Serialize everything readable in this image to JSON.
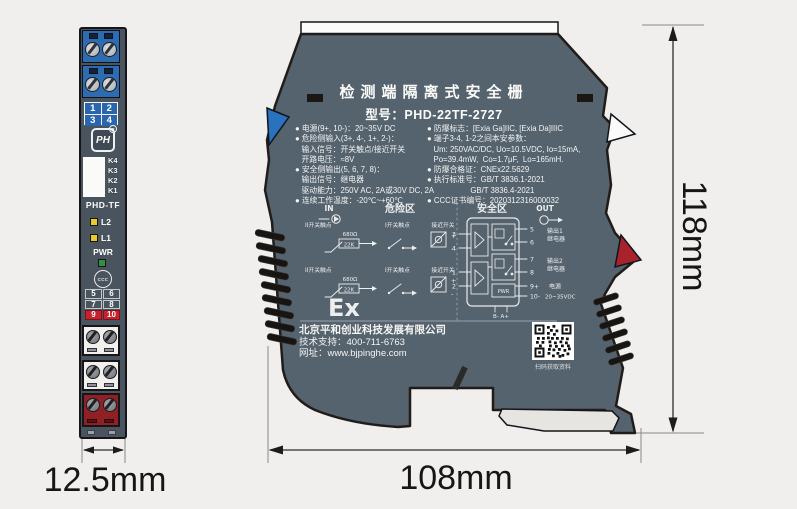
{
  "colors": {
    "background": "#f0efed",
    "body_gray": "#55636f",
    "front_gray": "#4a545e",
    "terminal_blue": "#2e6cb2",
    "terminal_red": "#8e2026",
    "tag_red": "#c4222c",
    "led_yellow": "#e8c92a",
    "led_green": "#2f9240"
  },
  "front": {
    "t_top": [
      "1",
      "2",
      "3",
      "4"
    ],
    "k": [
      "K4",
      "K3",
      "K2",
      "K1"
    ],
    "model": "PHD-TF",
    "l2": "L2",
    "l1": "L1",
    "pwr": "PWR",
    "ccc": "CCC",
    "logo": "PH",
    "reg": "R",
    "t_mid": [
      "5",
      "6",
      "7",
      "8"
    ],
    "t_pwr": [
      "9",
      "10"
    ]
  },
  "side": {
    "title": "检测端隔离式安全栅",
    "model": "型号：PHD-22TF-2727",
    "specs_left": [
      "● 电源(9+, 10-)：20~35V DC",
      "● 危险侧输入(3+, 4-, 1+, 2-)：",
      "   输入信号：开关触点/接近开关",
      "   开路电压：≈8V",
      "● 安全侧输出(5, 6, 7, 8)：",
      "   输出信号：继电器",
      "   驱动能力：250V AC, 2A或30V DC, 2A",
      "● 连续工作温度：-20℃~+60℃"
    ],
    "specs_right": [
      "● 防爆标志：[Exia Ga]IIC, [Exia Da]IIIC",
      "● 端子3-4, 1-2之间本安参数：",
      "   Um: 250VAC/DC, Uo=10.5VDC, Io=15mA,",
      "   Po=39.4mW,  Co=1.7μF,  Lo=165mH.",
      "● 防爆合格证：CNEx22.5629",
      "● 执行标准号：GB/T 3836.1-2021",
      "                    GB/T 3836.4-2021",
      "● CCC证书编号：2020312316000032"
    ],
    "sch": {
      "in": "IN",
      "out": "OUT",
      "hazard": "危险区",
      "safe": "安全区",
      "sw2": "II开关触点",
      "sw1": "I开关触点",
      "prox": "接近开关",
      "r680": "680Ω",
      "r22k": "22K",
      "plus": "+",
      "minus": "-",
      "t3": "3",
      "t4": "4",
      "t1": "1",
      "t2": "2",
      "t5": "5",
      "t6": "6",
      "t7": "7",
      "t8": "8",
      "t9": "9+",
      "t10": "10-",
      "out1a": "输出1",
      "out1b": "继电器",
      "out2a": "输出2",
      "out2b": "继电器",
      "pwra": "电源",
      "pwrb": "20~35VDC",
      "pwrbox": "PWR",
      "bus": "B-  A+"
    },
    "ex": "Ex",
    "company": "北京平和创业科技发展有限公司",
    "support": "技术支持：400-711-6763",
    "web": "网址：www.bjpinghe.com",
    "qr": "扫码获取资料"
  },
  "dims": {
    "front_w": "12.5mm",
    "side_w": "108mm",
    "side_h": "118mm"
  }
}
